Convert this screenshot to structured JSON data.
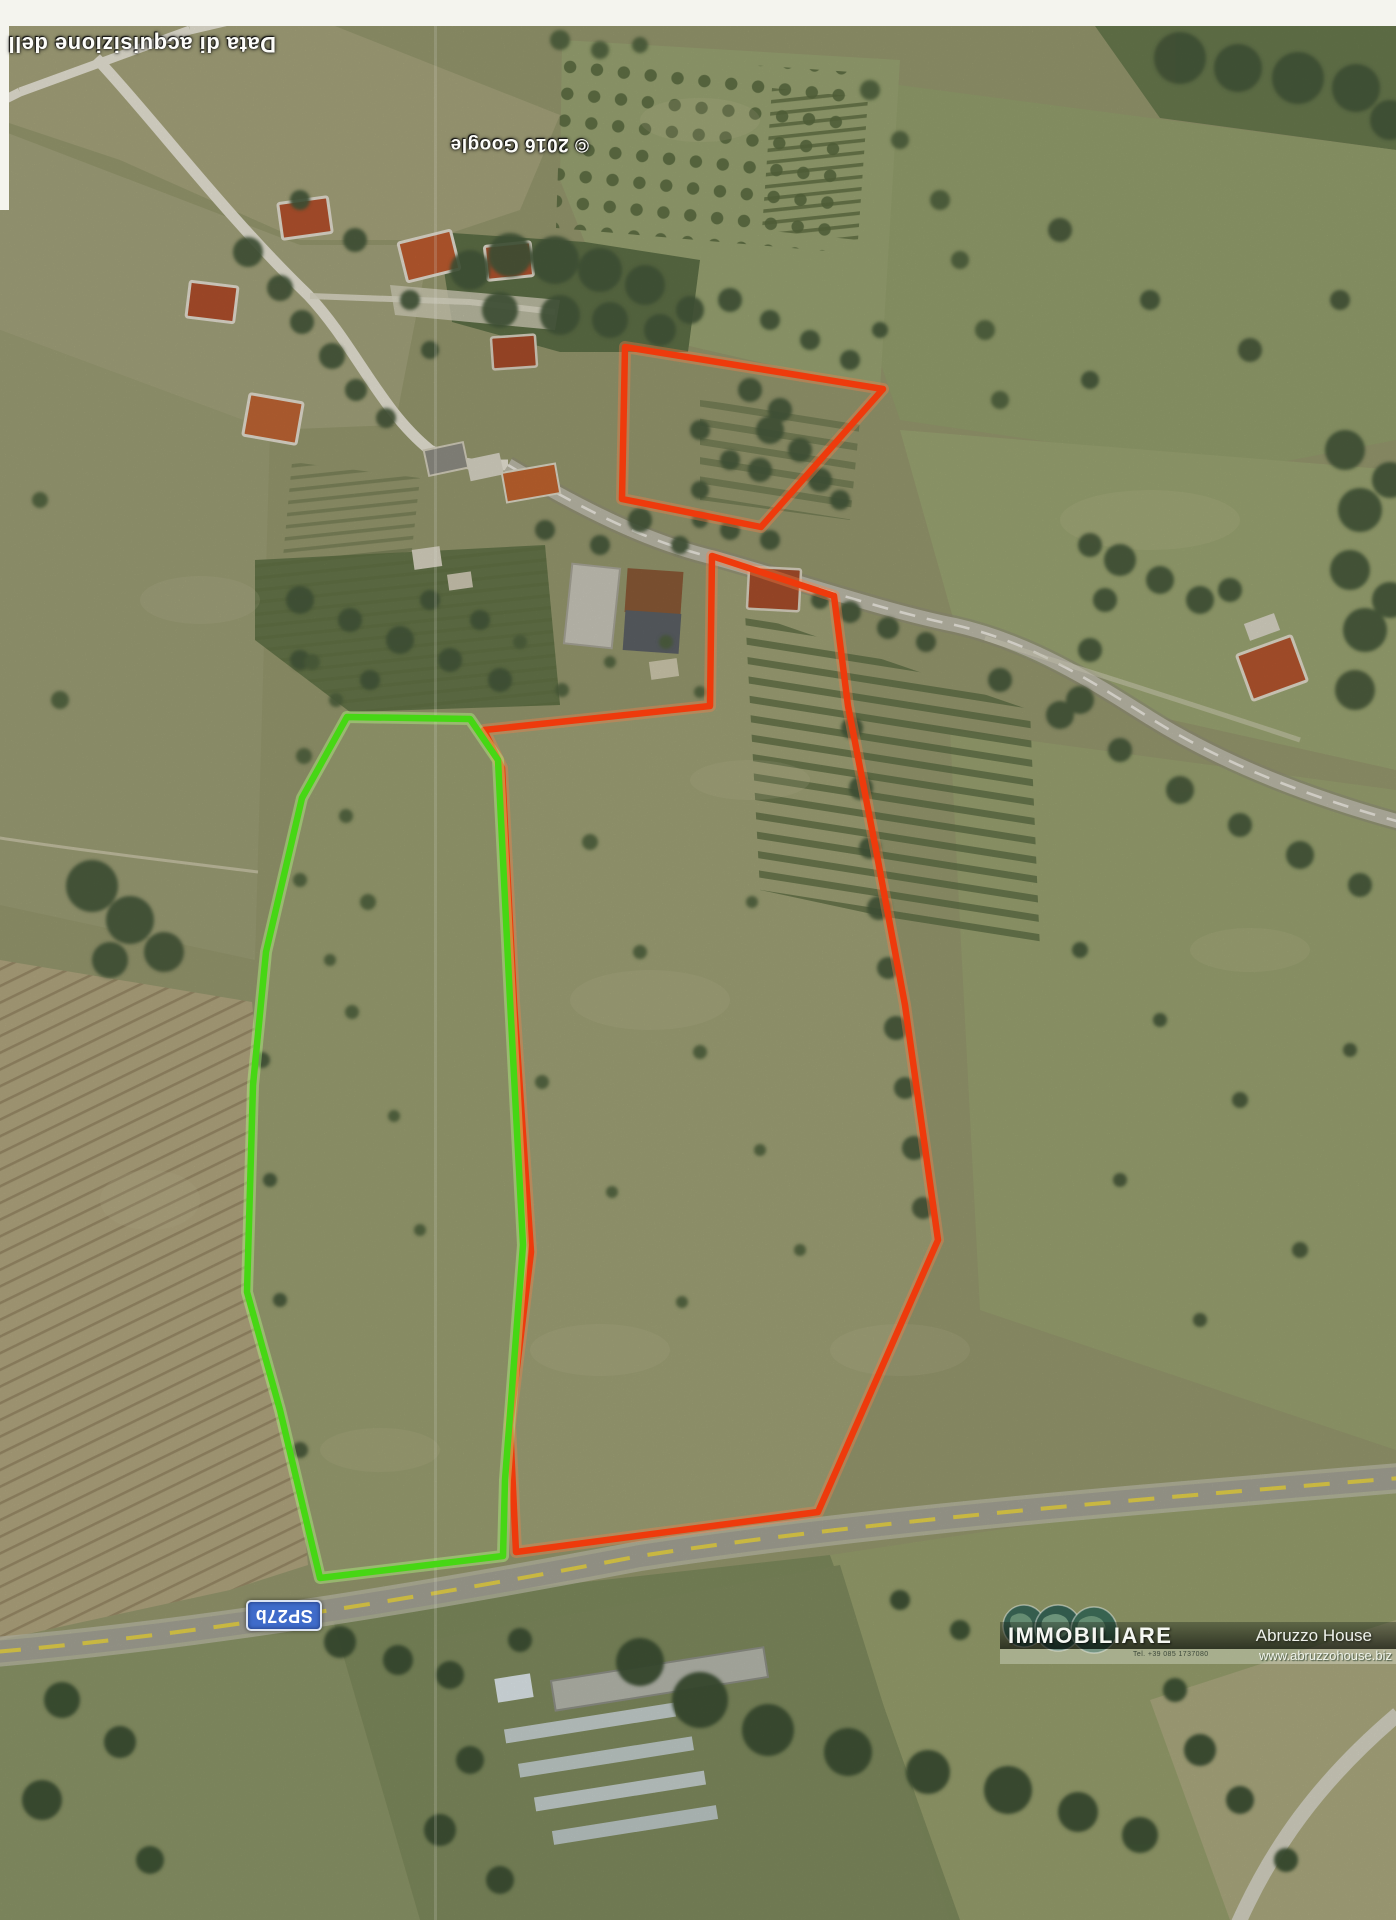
{
  "photo_labels": {
    "acquisition_caption": "Data di acquisizione dell",
    "google_credit": "© 2016 Google",
    "road_shield": "SP27b"
  },
  "watermark": {
    "brand": "IMMOBILIARE",
    "phone_small_print": "Tel. +39 085 1737080",
    "agency": "Abruzzo House",
    "website": "www.abruzzohouse.biz"
  },
  "annotation_colors": {
    "primary_parcel_outline": "#ee3a0c",
    "secondary_parcel_outline": "#46d714",
    "road_centerline_yellow": "#e6d34b",
    "road_shield_blue": "#3f6bca"
  }
}
